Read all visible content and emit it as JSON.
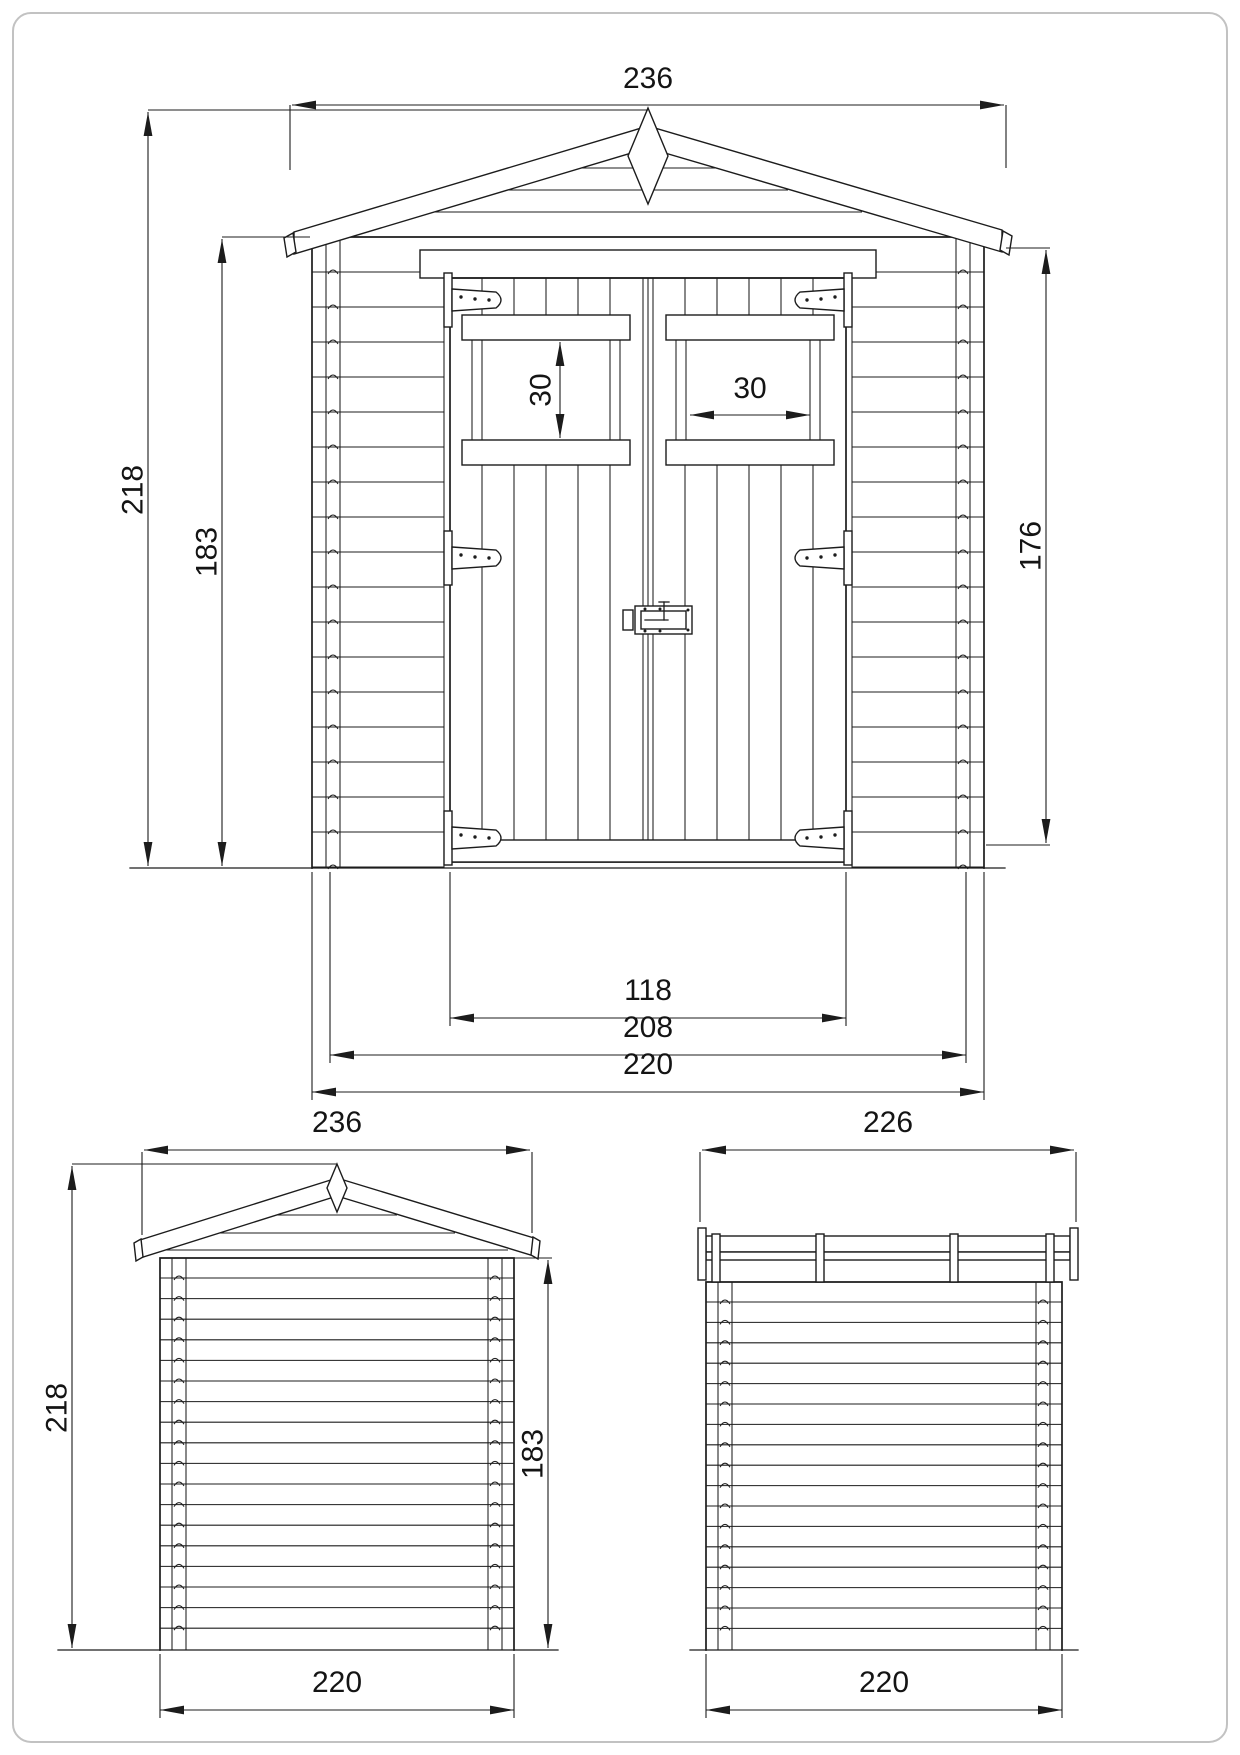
{
  "drawing": {
    "type": "technical-dimension-drawing",
    "subject": "wooden garden shed, three orthographic views",
    "line_color": "#1c1c1c",
    "border_color": "#c2c2c2",
    "views": {
      "front": {
        "dims": {
          "roof_width": "236",
          "total_height": "218",
          "wall_height": "183",
          "right_wall_height": "176",
          "window_height": "30",
          "window_width": "30",
          "door_opening_width": "118",
          "inner_width": "208",
          "base_width": "220"
        }
      },
      "rear": {
        "dims": {
          "roof_width": "236",
          "total_height": "218",
          "wall_height": "183",
          "base_width": "220"
        }
      },
      "side": {
        "dims": {
          "roof_depth": "226",
          "base_depth": "220"
        }
      }
    }
  }
}
